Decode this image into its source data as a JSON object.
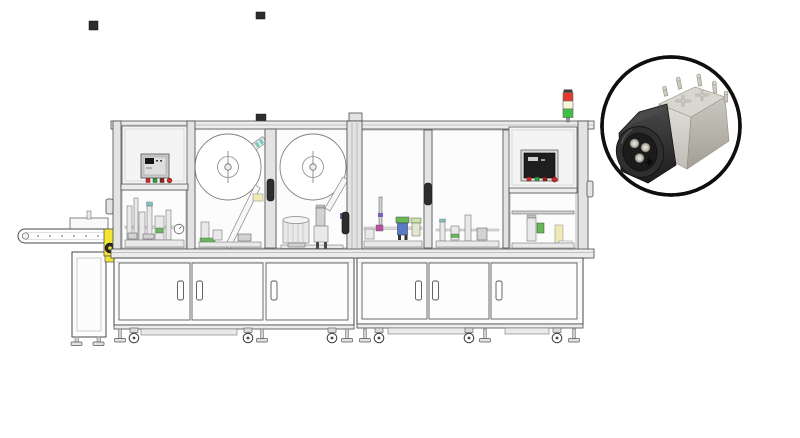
{
  "scene": {
    "description": "Technical line illustration of a two-module automated assembly machine with a circular product-photo inset of a connector",
    "machine": {
      "modules": 2,
      "upper_windows": 6,
      "material_reels": 2,
      "bowl_feeders": 1,
      "hmi_panels": 2,
      "hmi_buttons_per_panel": 4,
      "hmi_button_colors": [
        "red",
        "green",
        "dark-red",
        "red"
      ],
      "stack_light_lamps_top_to_bottom": [
        "red",
        "pale-yellow",
        "green"
      ],
      "cabinet_doors": 6,
      "door_handles": 6,
      "window_handles": 3,
      "casters": 6,
      "leveling_feet": 6,
      "outfeed_conveyor": true
    },
    "inset": {
      "shape": "circle",
      "subject": "connector with black keyed housing, three metal pins and silver terminal shield",
      "visible_front_pins": 3,
      "rear_terminal_posts": 5
    }
  },
  "colors": {
    "background": "#ffffff",
    "line": "#4a4a4a",
    "lamp_red": "#e23b2e",
    "lamp_yellow": "#fbf6da",
    "lamp_green": "#3fbf43",
    "btn_red": "#cf2b24",
    "btn_green": "#2f9e3d",
    "btn_dark_red": "#8f211c",
    "accent_yellow": "#f2e433",
    "pad_yellow": "#efe9b4",
    "accent_green": "#67b957",
    "accent_teal": "#79c9c1",
    "accent_purple": "#7a5fb5",
    "accent_magenta": "#bc4fa0",
    "accent_blue": "#5b79c9",
    "pale_green": "#cfe3a8",
    "inset_border": "#0f0f0f",
    "connector_black": "#2f2f2f",
    "connector_recess": "#1b1b1b",
    "connector_silver": "#d8d6ce",
    "connector_pin": "#b7b4aa",
    "screen_dark": "#1e1e1e"
  }
}
